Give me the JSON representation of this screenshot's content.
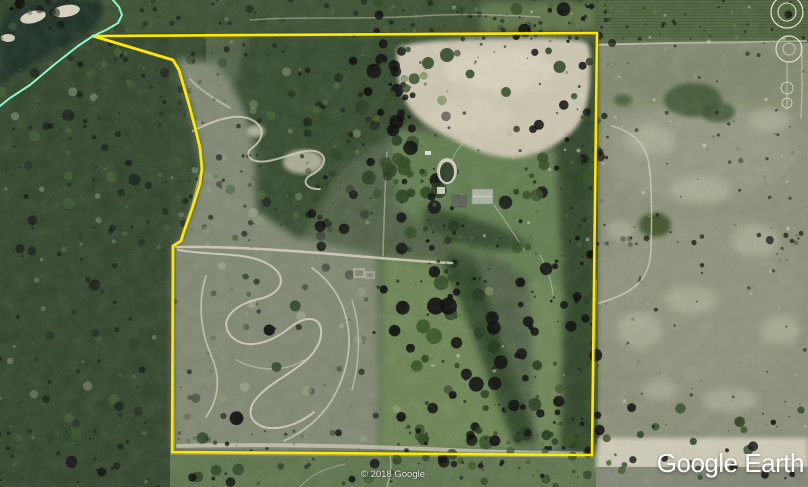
{
  "watermark": {
    "text": "Google Earth"
  },
  "attribution": {
    "text": "© 2018 Google"
  },
  "map": {
    "view": "satellite-aerial",
    "overlays": {
      "property_boundary": {
        "shape": "irregular-polygon",
        "color": "#ffe900"
      },
      "gps_track": {
        "color": "#8df7cc"
      }
    }
  }
}
